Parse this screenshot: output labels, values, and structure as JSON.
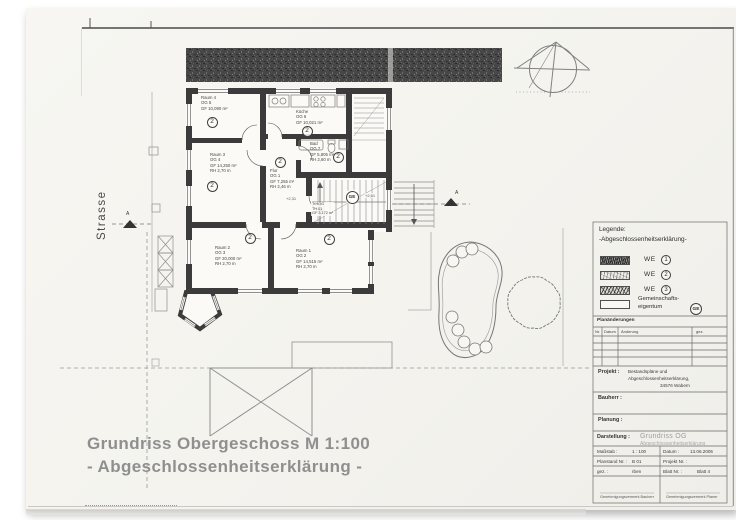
{
  "drawing": {
    "title_line1": "Grundriss Obergeschoss M 1:100",
    "title_line2": "- Abgeschlossenheitserklärung -",
    "street_label": "Strasse",
    "section_label": "A",
    "levels": {
      "left": "+2,31",
      "right": "+2,61"
    }
  },
  "legend": {
    "heading_line1": "Legende:",
    "heading_line2": "-Abgeschlossenheitserklärung-",
    "items": [
      {
        "label": "WE",
        "number": "1"
      },
      {
        "label": "WE",
        "number": "2"
      },
      {
        "label": "WE",
        "number": "3"
      }
    ],
    "common_line1": "Gemeinschafts-",
    "common_line2": "eigentum",
    "common_badge": "GE"
  },
  "rooms": {
    "raum4": {
      "name": "Raum 4",
      "code": "OG 5",
      "area": "GF 10,090 m²",
      "unit": "2"
    },
    "kueche": {
      "name": "Küche",
      "code": "OG 6",
      "area": "GF 10,021 m²",
      "unit": "2"
    },
    "bad": {
      "name": "Bad",
      "code": "OG 7",
      "area": "GF 5,805 m²",
      "height": "RH 2,60 m",
      "unit": "2"
    },
    "flur": {
      "name": "Flur",
      "code": "OG 1",
      "area": "GF 7,255 m²",
      "height": "RH 2,46 m",
      "unit": "2"
    },
    "raum3": {
      "name": "Raum 3",
      "code": "OG 4",
      "area": "GF 14,250 m²",
      "height": "RH 2,70 m",
      "unit": "2"
    },
    "raum2": {
      "name": "Raum 2",
      "code": "OG 3",
      "area": "GF 20,000 m²",
      "height": "RH 2,70 m",
      "unit": "2"
    },
    "raum1": {
      "name": "Raum 1",
      "code": "OG 2",
      "area": "GF 14,515 m²",
      "height": "RH 2,70 m",
      "unit": "2"
    },
    "treppenhaus": {
      "name": "TrHOG",
      "code": "TH 01",
      "area": "GF 3,172 m²",
      "badge": "GE"
    }
  },
  "titleblock": {
    "changes_heading": "Planänderungen",
    "changes_columns": [
      "Nr.",
      "Datum",
      "Änderung",
      "gez."
    ],
    "projekt_label": "Projekt :",
    "projekt_line1": "Bestandspläne und",
    "projekt_line2": "Abgeschlossenheitserklärung,",
    "projekt_line3": "34576 Wabern",
    "bauherr_label": "Bauherr :",
    "planung_label": "Planung :",
    "darstellung_label": "Darstellung :",
    "darstellung_line1": "Grundriss OG",
    "darstellung_line2": "Abgeschlossenheitserklärung",
    "massstab_label": "Maßstab :",
    "massstab_value": "1 : 100",
    "datum_label": "Datum :",
    "datum_value": "13.06.2005",
    "planstand_label": "Planstand Nr. :",
    "planstand_value": "B 01",
    "projektnr_label": "Projekt Nr. :",
    "gez_label": "gez. :",
    "gez_value": "rben",
    "blatt_label": "Blatt Nr. :",
    "blatt_value": "Blatt 4",
    "approval_left": "Genehmigungsvermerk Bauherr",
    "approval_right": "Genehmigungsvermerk Planer"
  },
  "colors": {
    "wall": "#3b3b3b",
    "paper": "#f5f4f0",
    "ink": "#4a4a4a",
    "title_gray": "#8f8f8f"
  }
}
